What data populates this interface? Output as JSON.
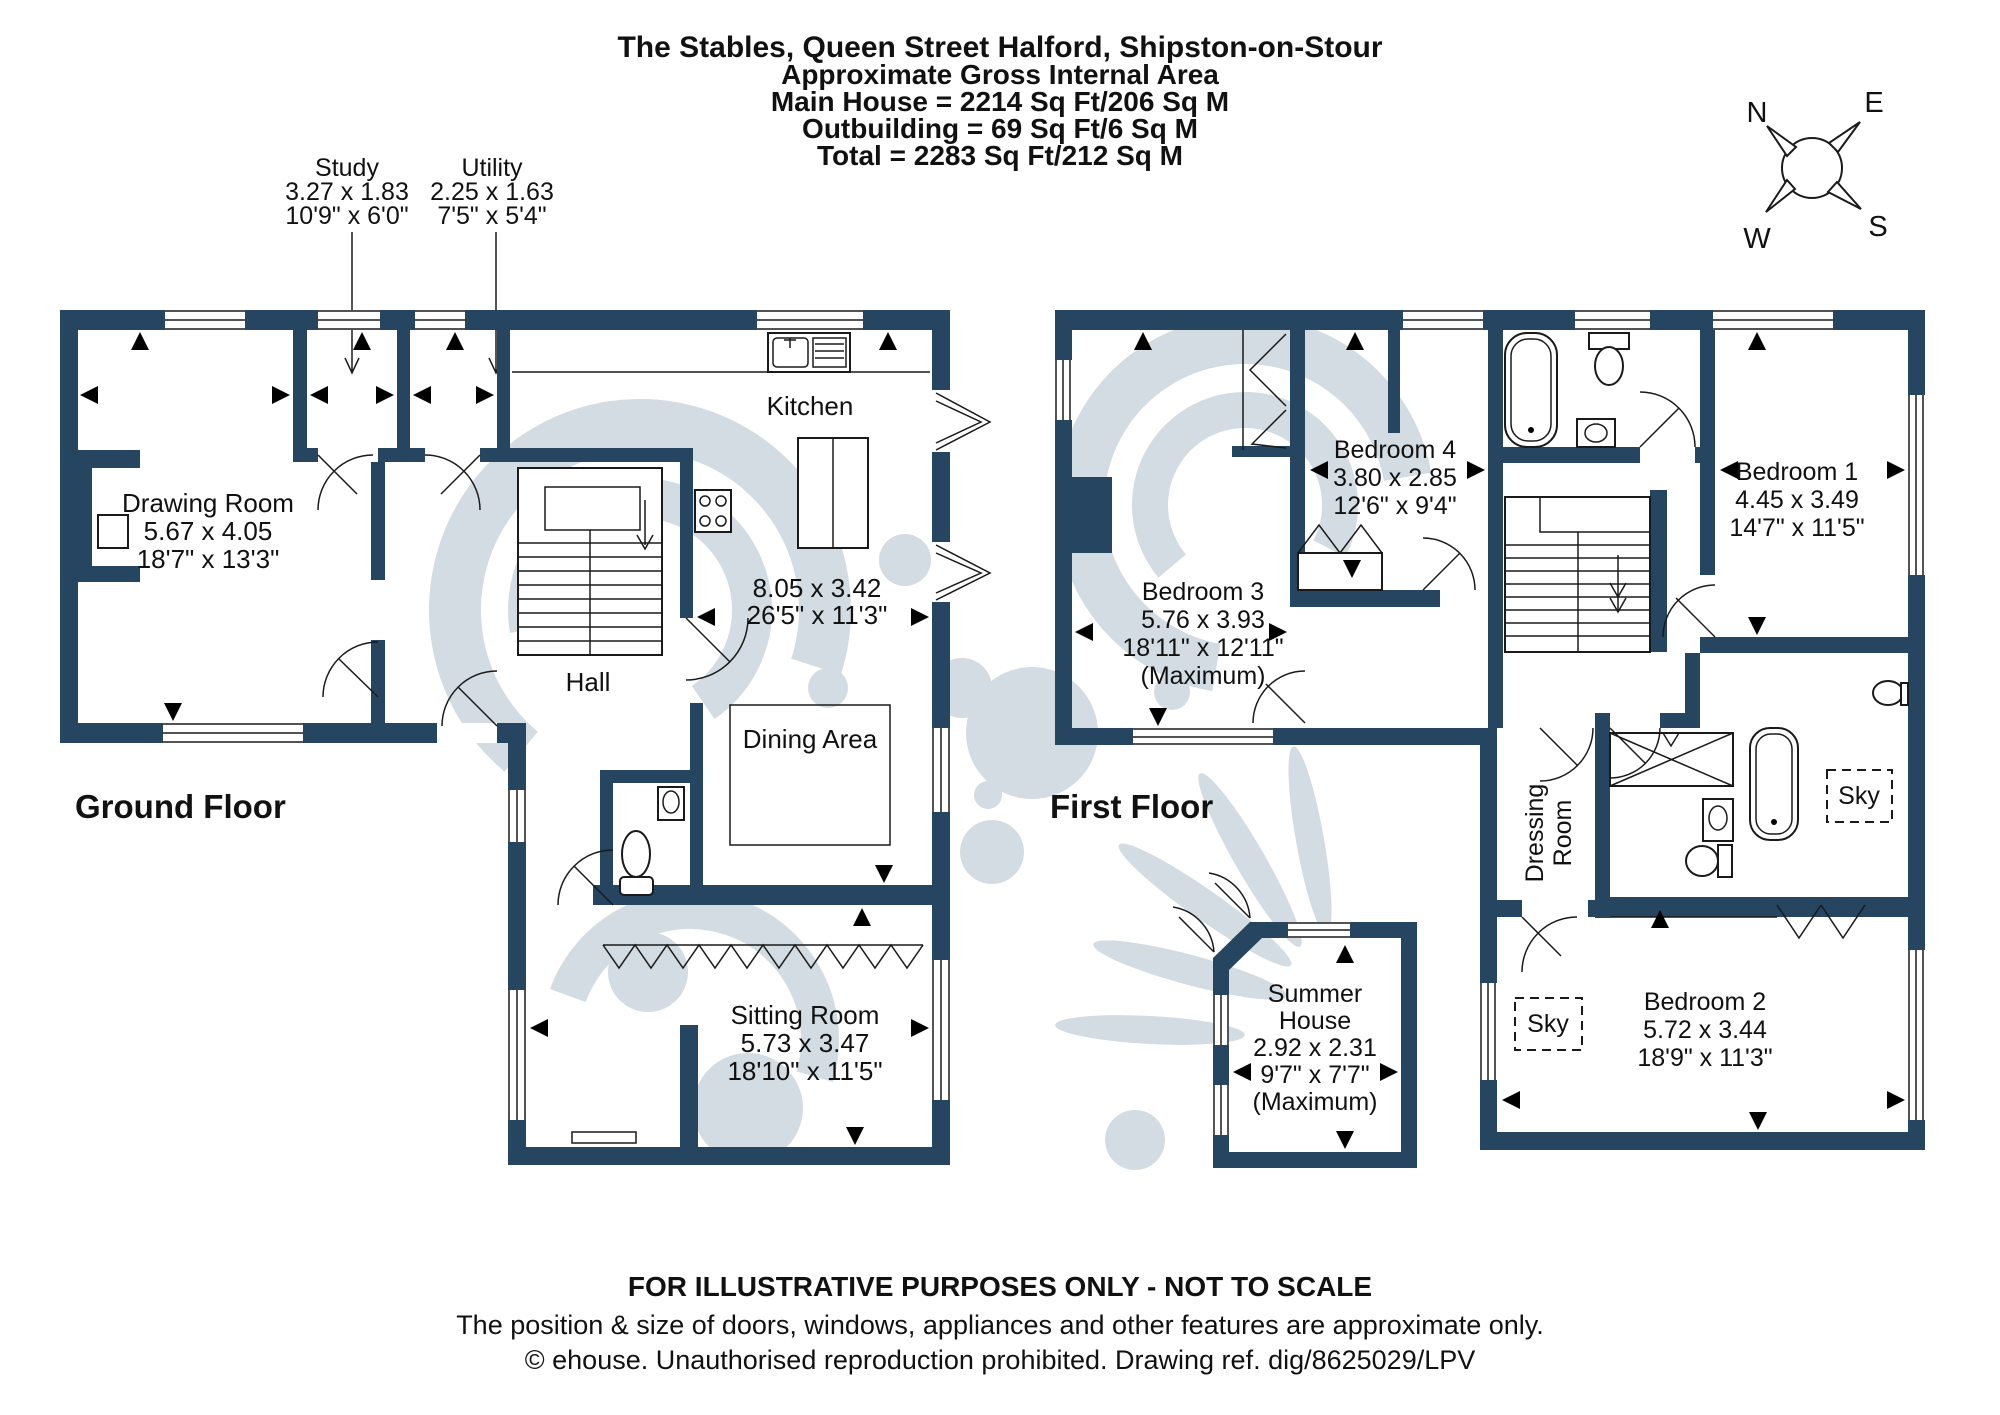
{
  "title": {
    "lines": [
      "The Stables, Queen Street Halford, Shipston-on-Stour",
      "Approximate Gross Internal Area",
      "Main House = 2214 Sq Ft/206 Sq M",
      "Outbuilding = 69 Sq Ft/6 Sq M",
      "Total = 2283 Sq Ft/212 Sq M"
    ]
  },
  "floors": {
    "ground": {
      "label": "Ground Floor"
    },
    "first": {
      "label": "First Floor"
    }
  },
  "annotations": {
    "study": {
      "name": "Study",
      "metric": "3.27 x 1.83",
      "imperial": "10'9\" x 6'0\""
    },
    "utility": {
      "name": "Utility",
      "metric": "2.25 x 1.63",
      "imperial": "7'5\" x 5'4\""
    }
  },
  "rooms": {
    "drawing": {
      "name": "Drawing Room",
      "metric": "5.67 x 4.05",
      "imperial": "18'7\" x 13'3\""
    },
    "kitchen": {
      "name": "Kitchen"
    },
    "kitchen_dining": {
      "metric": "8.05 x 3.42",
      "imperial": "26'5\" x 11'3\""
    },
    "hall": {
      "name": "Hall"
    },
    "dining": {
      "name": "Dining Area"
    },
    "sitting": {
      "name": "Sitting Room",
      "metric": "5.73 x 3.47",
      "imperial": "18'10\" x 11'5\""
    },
    "bedroom1": {
      "name": "Bedroom 1",
      "metric": "4.45 x 3.49",
      "imperial": "14'7\" x 11'5\""
    },
    "bedroom2": {
      "name": "Bedroom 2",
      "metric": "5.72 x 3.44",
      "imperial": "18'9\" x 11'3\""
    },
    "bedroom3": {
      "name": "Bedroom 3",
      "metric": "5.76 x 3.93",
      "imperial": "18'11\" x 12'11\"",
      "note": "(Maximum)"
    },
    "bedroom4": {
      "name": "Bedroom 4",
      "metric": "3.80 x 2.85",
      "imperial": "12'6\" x 9'4\""
    },
    "dressing": {
      "line1": "Dressing",
      "line2": "Room"
    },
    "summer": {
      "line1": "Summer",
      "line2": "House",
      "metric": "2.92 x 2.31",
      "imperial": "9'7\" x 7'7\"",
      "note": "(Maximum)"
    },
    "sky": {
      "label": "Sky"
    }
  },
  "compass": {
    "n": "N",
    "e": "E",
    "s": "S",
    "w": "W"
  },
  "footer": {
    "line1": "FOR ILLUSTRATIVE PURPOSES ONLY - NOT TO SCALE",
    "line2": "The position & size of doors, windows, appliances and other features are approximate only.",
    "line3": "© ehouse. Unauthorised reproduction prohibited. Drawing ref. dig/8625029/LPV"
  },
  "colors": {
    "wall": "#254560",
    "watermark": "#cfd8df",
    "line": "#1a1a1a",
    "text": "#111111"
  }
}
